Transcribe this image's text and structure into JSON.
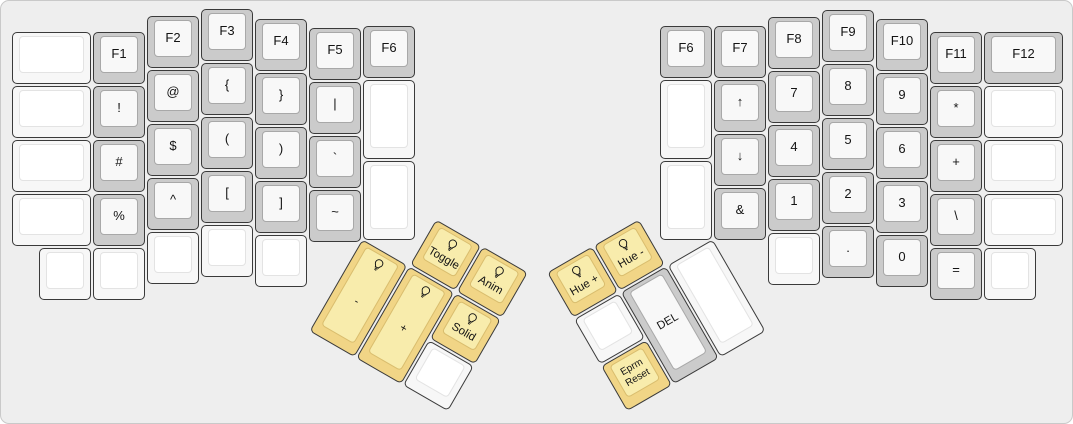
{
  "board": {
    "width": 1073,
    "height": 424,
    "background": "#eeeeee",
    "frame_border": "#c9c9c9",
    "key_outline": "#3a3a3a",
    "text_color": "#141414"
  },
  "key_colors": {
    "white": {
      "base": "#f7f7f7",
      "top": "#ffffff",
      "top_border": "#e3e3e3"
    },
    "gray": {
      "base": "#cbcbcb",
      "top": "#f8f8f8",
      "top_border": "#a8a8a8"
    },
    "yellow": {
      "base": "#f1d586",
      "top": "#f8ecac",
      "top_border": "#d9bd6e"
    }
  },
  "icons": {
    "lightbulb": "lightbulb-icon"
  },
  "keys": [
    {
      "name": "blank-l-col0-r0",
      "label": "",
      "color": "white",
      "x": 10,
      "y": 30,
      "w": 81,
      "h": 54
    },
    {
      "name": "blank-l-col0-r1",
      "label": "",
      "color": "white",
      "x": 10,
      "y": 84,
      "w": 81,
      "h": 54
    },
    {
      "name": "blank-l-col0-r2",
      "label": "",
      "color": "white",
      "x": 10,
      "y": 138,
      "w": 81,
      "h": 54
    },
    {
      "name": "blank-l-col0-r3",
      "label": "",
      "color": "white",
      "x": 10,
      "y": 192,
      "w": 81,
      "h": 54
    },
    {
      "name": "f1",
      "label": "F1",
      "color": "gray",
      "x": 91,
      "y": 30,
      "w": 54,
      "h": 54
    },
    {
      "name": "exclamation",
      "label": "!",
      "color": "gray",
      "x": 91,
      "y": 84,
      "w": 54,
      "h": 54
    },
    {
      "name": "hash",
      "label": "#",
      "color": "gray",
      "x": 91,
      "y": 138,
      "w": 54,
      "h": 54
    },
    {
      "name": "percent",
      "label": "%",
      "color": "gray",
      "x": 91,
      "y": 192,
      "w": 54,
      "h": 54
    },
    {
      "name": "f2",
      "label": "F2",
      "color": "gray",
      "x": 145,
      "y": 14,
      "w": 54,
      "h": 54
    },
    {
      "name": "at",
      "label": "@",
      "color": "gray",
      "x": 145,
      "y": 68,
      "w": 54,
      "h": 54
    },
    {
      "name": "dollar",
      "label": "$",
      "color": "gray",
      "x": 145,
      "y": 122,
      "w": 54,
      "h": 54
    },
    {
      "name": "caret",
      "label": "^",
      "color": "gray",
      "x": 145,
      "y": 176,
      "w": 54,
      "h": 54
    },
    {
      "name": "f3",
      "label": "F3",
      "color": "gray",
      "x": 199,
      "y": 7,
      "w": 54,
      "h": 54
    },
    {
      "name": "brace-open",
      "label": "{",
      "color": "gray",
      "x": 199,
      "y": 61,
      "w": 54,
      "h": 54
    },
    {
      "name": "paren-open",
      "label": "(",
      "color": "gray",
      "x": 199,
      "y": 115,
      "w": 54,
      "h": 54
    },
    {
      "name": "bracket-open",
      "label": "[",
      "color": "gray",
      "x": 199,
      "y": 169,
      "w": 54,
      "h": 54
    },
    {
      "name": "f4",
      "label": "F4",
      "color": "gray",
      "x": 253,
      "y": 17,
      "w": 54,
      "h": 54
    },
    {
      "name": "brace-close",
      "label": "}",
      "color": "gray",
      "x": 253,
      "y": 71,
      "w": 54,
      "h": 54
    },
    {
      "name": "paren-close",
      "label": ")",
      "color": "gray",
      "x": 253,
      "y": 125,
      "w": 54,
      "h": 54
    },
    {
      "name": "bracket-close",
      "label": "]",
      "color": "gray",
      "x": 253,
      "y": 179,
      "w": 54,
      "h": 54
    },
    {
      "name": "f5",
      "label": "F5",
      "color": "gray",
      "x": 307,
      "y": 26,
      "w": 54,
      "h": 54
    },
    {
      "name": "pipe",
      "label": "|",
      "color": "gray",
      "x": 307,
      "y": 80,
      "w": 54,
      "h": 54
    },
    {
      "name": "backtick",
      "label": "`",
      "color": "gray",
      "x": 307,
      "y": 134,
      "w": 54,
      "h": 54
    },
    {
      "name": "tilde",
      "label": "~",
      "color": "gray",
      "x": 307,
      "y": 188,
      "w": 54,
      "h": 54
    },
    {
      "name": "f6-left",
      "label": "F6",
      "color": "gray",
      "x": 361,
      "y": 24,
      "w": 54,
      "h": 54
    },
    {
      "name": "blank-l-inner-top",
      "label": "",
      "color": "white",
      "x": 361,
      "y": 78,
      "w": 54,
      "h": 81
    },
    {
      "name": "blank-l-inner-bottom",
      "label": "",
      "color": "white",
      "x": 361,
      "y": 159,
      "w": 54,
      "h": 81
    },
    {
      "name": "blank-l-bottom-1",
      "label": "",
      "color": "white",
      "x": 37,
      "y": 246,
      "w": 54,
      "h": 54
    },
    {
      "name": "blank-l-bottom-2",
      "label": "",
      "color": "white",
      "x": 91,
      "y": 246,
      "w": 54,
      "h": 54
    },
    {
      "name": "blank-l-bottom-3",
      "label": "",
      "color": "white",
      "x": 145,
      "y": 230,
      "w": 54,
      "h": 54
    },
    {
      "name": "blank-l-bottom-4",
      "label": "",
      "color": "white",
      "x": 199,
      "y": 223,
      "w": 54,
      "h": 54
    },
    {
      "name": "blank-l-bottom-5",
      "label": "",
      "color": "white",
      "x": 253,
      "y": 233,
      "w": 54,
      "h": 54
    },
    {
      "name": "f6-right",
      "label": "F6",
      "color": "gray",
      "x": 658,
      "y": 24,
      "w": 54,
      "h": 54
    },
    {
      "name": "blank-r-inner-top",
      "label": "",
      "color": "white",
      "x": 658,
      "y": 78,
      "w": 54,
      "h": 81
    },
    {
      "name": "blank-r-inner-bottom",
      "label": "",
      "color": "white",
      "x": 658,
      "y": 159,
      "w": 54,
      "h": 81
    },
    {
      "name": "f7",
      "label": "F7",
      "color": "gray",
      "x": 712,
      "y": 24,
      "w": 54,
      "h": 54
    },
    {
      "name": "arrow-up",
      "label": "↑",
      "color": "gray",
      "x": 712,
      "y": 78,
      "w": 54,
      "h": 54
    },
    {
      "name": "arrow-down",
      "label": "↓",
      "color": "gray",
      "x": 712,
      "y": 132,
      "w": 54,
      "h": 54
    },
    {
      "name": "ampersand",
      "label": "&",
      "color": "gray",
      "x": 712,
      "y": 186,
      "w": 54,
      "h": 54
    },
    {
      "name": "f8",
      "label": "F8",
      "color": "gray",
      "x": 766,
      "y": 15,
      "w": 54,
      "h": 54
    },
    {
      "name": "num-7",
      "label": "7",
      "color": "gray",
      "x": 766,
      "y": 69,
      "w": 54,
      "h": 54
    },
    {
      "name": "num-4",
      "label": "4",
      "color": "gray",
      "x": 766,
      "y": 123,
      "w": 54,
      "h": 54
    },
    {
      "name": "num-1",
      "label": "1",
      "color": "gray",
      "x": 766,
      "y": 177,
      "w": 54,
      "h": 54
    },
    {
      "name": "f9",
      "label": "F9",
      "color": "gray",
      "x": 820,
      "y": 8,
      "w": 54,
      "h": 54
    },
    {
      "name": "num-8",
      "label": "8",
      "color": "gray",
      "x": 820,
      "y": 62,
      "w": 54,
      "h": 54
    },
    {
      "name": "num-5",
      "label": "5",
      "color": "gray",
      "x": 820,
      "y": 116,
      "w": 54,
      "h": 54
    },
    {
      "name": "num-2",
      "label": "2",
      "color": "gray",
      "x": 820,
      "y": 170,
      "w": 54,
      "h": 54
    },
    {
      "name": "f10",
      "label": "F10",
      "color": "gray",
      "x": 874,
      "y": 17,
      "w": 54,
      "h": 54
    },
    {
      "name": "num-9",
      "label": "9",
      "color": "gray",
      "x": 874,
      "y": 71,
      "w": 54,
      "h": 54
    },
    {
      "name": "num-6",
      "label": "6",
      "color": "gray",
      "x": 874,
      "y": 125,
      "w": 54,
      "h": 54
    },
    {
      "name": "num-3",
      "label": "3",
      "color": "gray",
      "x": 874,
      "y": 179,
      "w": 54,
      "h": 54
    },
    {
      "name": "f11",
      "label": "F11",
      "color": "gray",
      "x": 928,
      "y": 30,
      "w": 54,
      "h": 54
    },
    {
      "name": "asterisk",
      "label": "*",
      "color": "gray",
      "x": 928,
      "y": 84,
      "w": 54,
      "h": 54
    },
    {
      "name": "plus",
      "label": "+",
      "color": "gray",
      "x": 928,
      "y": 138,
      "w": 54,
      "h": 54
    },
    {
      "name": "backslash",
      "label": "\\",
      "color": "gray",
      "x": 928,
      "y": 192,
      "w": 54,
      "h": 54
    },
    {
      "name": "f12",
      "label": "F12",
      "color": "gray",
      "x": 982,
      "y": 30,
      "w": 81,
      "h": 54
    },
    {
      "name": "blank-r-col6-r1",
      "label": "",
      "color": "white",
      "x": 982,
      "y": 84,
      "w": 81,
      "h": 54
    },
    {
      "name": "blank-r-col6-r2",
      "label": "",
      "color": "white",
      "x": 982,
      "y": 138,
      "w": 81,
      "h": 54
    },
    {
      "name": "blank-r-col6-r3",
      "label": "",
      "color": "white",
      "x": 982,
      "y": 192,
      "w": 81,
      "h": 54
    },
    {
      "name": "blank-r-bottom-1",
      "label": "",
      "color": "white",
      "x": 766,
      "y": 231,
      "w": 54,
      "h": 54
    },
    {
      "name": "period",
      "label": ".",
      "color": "gray",
      "x": 820,
      "y": 224,
      "w": 54,
      "h": 54
    },
    {
      "name": "num-0",
      "label": "0",
      "color": "gray",
      "x": 874,
      "y": 233,
      "w": 54,
      "h": 54
    },
    {
      "name": "equals",
      "label": "=",
      "color": "gray",
      "x": 928,
      "y": 246,
      "w": 54,
      "h": 54
    },
    {
      "name": "blank-r-bottom-2",
      "label": "",
      "color": "white",
      "x": 982,
      "y": 246,
      "w": 54,
      "h": 54
    }
  ],
  "thumb_clusters": [
    {
      "name": "left-thumb-cluster",
      "rx": 361,
      "ry": 237,
      "rotation": 30,
      "keys": [
        {
          "name": "rgb-toggle",
          "label": "Toggle",
          "color": "yellow",
          "icon": "lightbulb",
          "x": 54,
          "y": -54,
          "w": 54,
          "h": 54
        },
        {
          "name": "rgb-anim",
          "label": "Anim",
          "color": "yellow",
          "icon": "lightbulb",
          "x": 108,
          "y": -54,
          "w": 54,
          "h": 54
        },
        {
          "name": "rgb-brightness-down",
          "label": "-",
          "color": "yellow",
          "icon": "lightbulb",
          "x": 0,
          "y": 0,
          "w": 54,
          "h": 108
        },
        {
          "name": "rgb-brightness-up",
          "label": "+",
          "color": "yellow",
          "icon": "lightbulb",
          "x": 54,
          "y": 0,
          "w": 54,
          "h": 108
        },
        {
          "name": "rgb-solid",
          "label": "Solid",
          "color": "yellow",
          "icon": "lightbulb",
          "x": 108,
          "y": 0,
          "w": 54,
          "h": 54
        },
        {
          "name": "blank-l-thumb",
          "label": "",
          "color": "white",
          "x": 108,
          "y": 54,
          "w": 54,
          "h": 54
        }
      ]
    },
    {
      "name": "right-thumb-cluster",
      "rx": 712,
      "ry": 237,
      "rotation": -30,
      "keys": [
        {
          "name": "rgb-hue-plus",
          "label": "Hue +",
          "color": "yellow",
          "icon": "lightbulb",
          "x": -162,
          "y": -54,
          "w": 54,
          "h": 54
        },
        {
          "name": "rgb-hue-minus",
          "label": "Hue -",
          "color": "yellow",
          "icon": "lightbulb",
          "x": -108,
          "y": -54,
          "w": 54,
          "h": 54
        },
        {
          "name": "blank-r-thumb-1",
          "label": "",
          "color": "white",
          "x": -162,
          "y": 0,
          "w": 54,
          "h": 54
        },
        {
          "name": "del",
          "label": "DEL",
          "color": "gray",
          "x": -108,
          "y": 0,
          "w": 54,
          "h": 108
        },
        {
          "name": "blank-r-thumb-2",
          "label": "",
          "color": "white",
          "x": -54,
          "y": 0,
          "w": 54,
          "h": 108
        },
        {
          "name": "eprm-reset",
          "label": "Eprm Reset",
          "lines": [
            "Eprm",
            "Reset"
          ],
          "color": "yellow",
          "x": -162,
          "y": 54,
          "w": 54,
          "h": 54
        }
      ]
    }
  ]
}
